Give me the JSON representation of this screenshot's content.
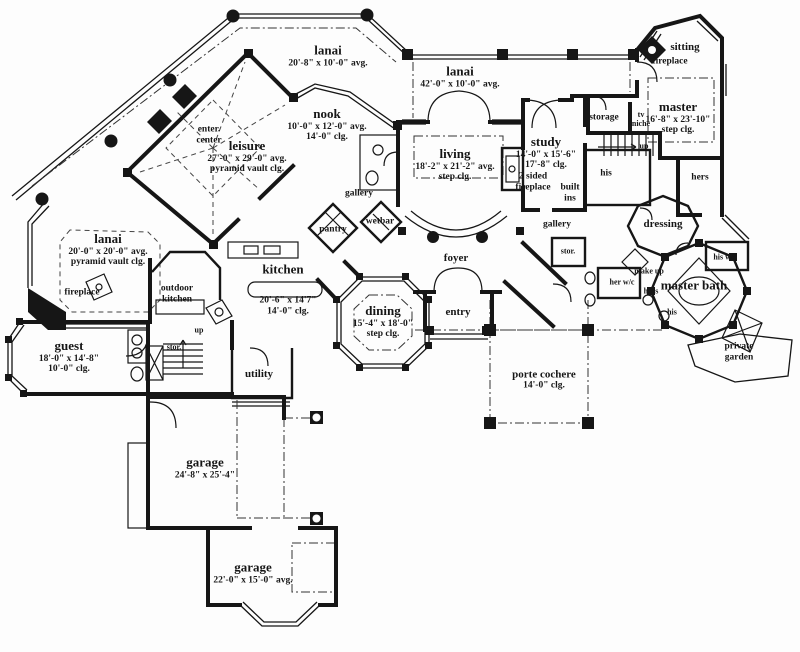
{
  "meta": {
    "drawing_type": "first floor plan",
    "ink_color": "#161616",
    "paper_color": "#fdfdfd"
  },
  "rooms": {
    "lanai_top": {
      "title": "lanai",
      "l1": "20'-8\" x 10'-0\" avg."
    },
    "lanai_wide": {
      "title": "lanai",
      "l1": "42'-0\" x 10'-0\" avg."
    },
    "nook": {
      "title": "nook",
      "l1": "10'-0\" x 12'-0\" avg.",
      "l2": "14'-0\" clg."
    },
    "leisure": {
      "title": "leisure",
      "l1": "27'-0\" x 29'-0\" avg.",
      "l2": "pyramid vault clg."
    },
    "living": {
      "title": "living",
      "l1": "18'-2\" x 21'-2\" avg.",
      "l2": "step clg."
    },
    "study": {
      "title": "study",
      "l1": "14'-0\" x 15'-6\"",
      "l2": "17'-8\" clg."
    },
    "master": {
      "title": "master",
      "l1": "16'-8\" x 23'-10\"",
      "l2": "step clg."
    },
    "lanai_left": {
      "title": "lanai",
      "l1": "20'-0\" x 20'-0\" avg.",
      "l2": "pyramid vault clg."
    },
    "kitchen": {
      "title": "kitchen",
      "l1": "20'-6\" x 14'7\"",
      "l2": "14'-0\" clg."
    },
    "dining": {
      "title": "dining",
      "l1": "15'-4\" x 18'-0\"",
      "l2": "step clg."
    },
    "guest": {
      "title": "guest",
      "l1": "18'-0\" x 14'-8\"",
      "l2": "10'-0\" clg."
    },
    "garage_main": {
      "title": "garage",
      "l1": "24'-8\" x 25'-4\""
    },
    "garage_lower": {
      "title": "garage",
      "l1": "22'-0\" x 15'-0\" avg."
    },
    "porte_cochere": {
      "title": "porte cochere",
      "l1": "14'-0\" clg."
    },
    "master_bath": {
      "title": "master bath"
    },
    "sitting": {
      "title": "sitting"
    },
    "foyer": {
      "title": "foyer"
    },
    "entry": {
      "title": "entry"
    },
    "dressing": {
      "title": "dressing"
    },
    "utility": {
      "title": "utility"
    }
  },
  "labels": {
    "enter_center": {
      "l1": "enter.",
      "l2": "center"
    },
    "gallery_left": "gallery",
    "gallery_right": "gallery",
    "wetbar": "wetbar",
    "pantry": "pantry",
    "storage": "storage",
    "tv_niche": {
      "l1": "tv",
      "l2": "niche"
    },
    "up_right": "up",
    "up_left": "up",
    "fireplace_sitting": "fireplace",
    "fireplace_left": "fireplace",
    "two_sided_fireplace": {
      "l1": "2 sided",
      "l2": "fireplace"
    },
    "built_ins": {
      "l1": "built",
      "l2": "ins"
    },
    "his_closet": "his",
    "hers_closet": "hers",
    "stor_right": "stor.",
    "stor_left": "stor.",
    "make_up": "make up",
    "her_wc": "her w/c",
    "hers_bath": "hers",
    "his_bath": "his",
    "his_wc": "his w/c",
    "private_garden": {
      "l1": "private",
      "l2": "garden"
    },
    "outdoor_kitchen": {
      "l1": "outdoor",
      "l2": "kitchen"
    }
  }
}
